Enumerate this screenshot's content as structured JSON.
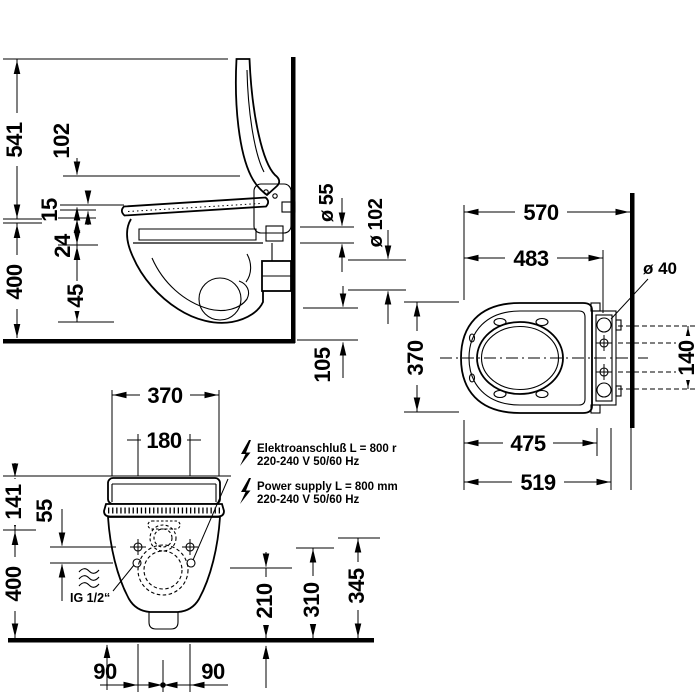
{
  "colors": {
    "ink": "#000000",
    "background": "#ffffff"
  },
  "side_view": {
    "dim_541": "541",
    "dim_102": "102",
    "dim_15": "15",
    "dim_24": "24",
    "dim_45": "45",
    "dim_400": "400"
  },
  "connections": {
    "dia_55": "ø 55",
    "dia_102": "ø 102",
    "dim_105": "105"
  },
  "top_view": {
    "dim_570": "570",
    "dim_483": "483",
    "dia_40": "ø 40",
    "dim_370": "370",
    "dim_140": "140",
    "dim_475": "475",
    "dim_519": "519"
  },
  "front_view": {
    "dim_370": "370",
    "dim_180": "180",
    "dim_141": "141",
    "dim_55": "55",
    "dim_400": "400",
    "dim_90_left": "90",
    "dim_90_right": "90",
    "dim_210": "210",
    "dim_310": "310",
    "dim_345": "345",
    "inlet_label": "IG 1/2“",
    "electro_line1": "Elektroanschluß L = 800 r",
    "electro_line2": "220-240 V  50/60 Hz",
    "power_line1": "Power supply L = 800 mm",
    "power_line2": "220-240 V  50/60 Hz"
  }
}
